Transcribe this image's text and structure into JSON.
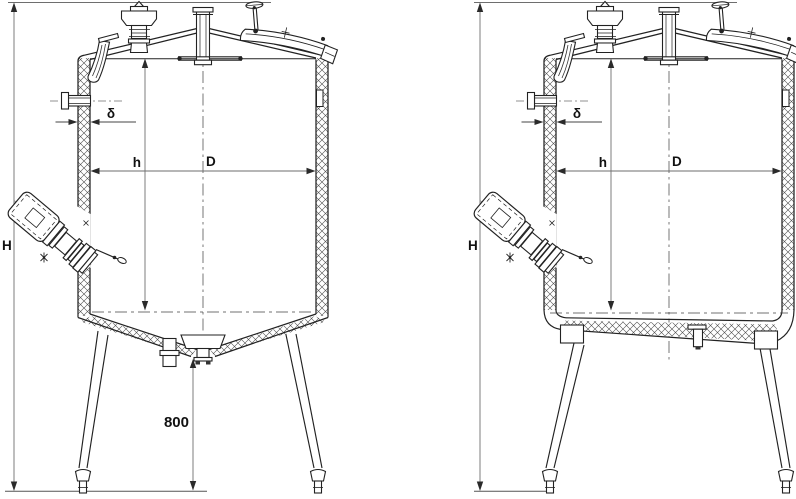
{
  "diagram": {
    "background": "#ffffff",
    "line_color": "#222222",
    "dim_line_color": "#6e6e6e",
    "views": [
      {
        "id": "left-tank",
        "bottom_type": "conical",
        "labels": {
          "overall_height": "H",
          "inner_height": "h",
          "diameter": "D",
          "wall_thickness": "δ",
          "leg_height": "800"
        }
      },
      {
        "id": "right-tank",
        "bottom_type": "flat",
        "labels": {
          "overall_height": "H",
          "inner_height": "h",
          "diameter": "D",
          "wall_thickness": "δ"
        }
      }
    ]
  }
}
